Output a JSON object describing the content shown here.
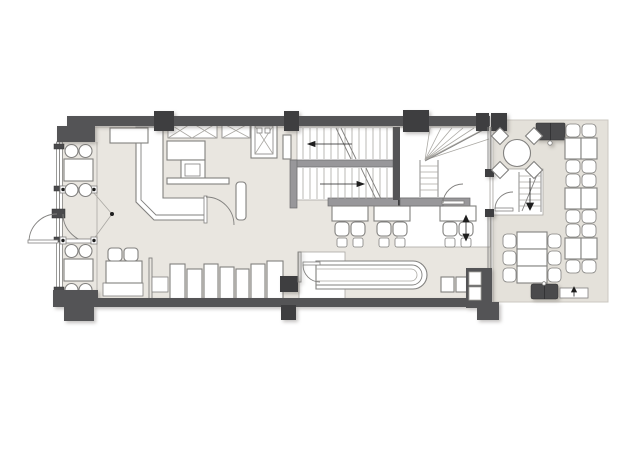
{
  "document": {
    "kind": "architectural floor plan",
    "subject": "restaurant ground floor with open kitchen, bar, staircases and dining terrace",
    "visible_text": ""
  },
  "colors": {
    "background": "#ffffff",
    "floor": "#e9e6e0",
    "terrace_floor": "#e4e1da",
    "floor_edge": "#cbc8c1",
    "wall": "#545456",
    "column": "#3e3e40",
    "dark_item": "#4a4a4c",
    "rail": "#98979a",
    "line": "#82817f",
    "light_line": "#aaa8a3",
    "marker": "#1f1f1f"
  },
  "inventory": {
    "interior": {
      "window_tables": {
        "count": 2,
        "seats_each": 4
      },
      "queue_barriers": 2,
      "lounge_seat": 1,
      "curved_banquette": 1,
      "host_stand": 1,
      "open_kitchen_counters": 3,
      "wall_shelves_crosshatched": 2,
      "dumbwaiter": 1,
      "equipment_units": 7,
      "long_bar_counter": 1,
      "counter_tables": {
        "count": 3,
        "seats_each": 2
      },
      "main_staircase_runs": 2,
      "winder_staircase": 1,
      "entry_doors": 2,
      "interior_doors": 3
    },
    "terrace": {
      "round_table": {
        "count": 1,
        "seats": 4
      },
      "paired_table_groups": {
        "count": 3,
        "seats_each": 4
      },
      "long_table_group": {
        "count": 1,
        "seats": 6
      },
      "service_stations": 2,
      "access_steps": 1
    }
  }
}
